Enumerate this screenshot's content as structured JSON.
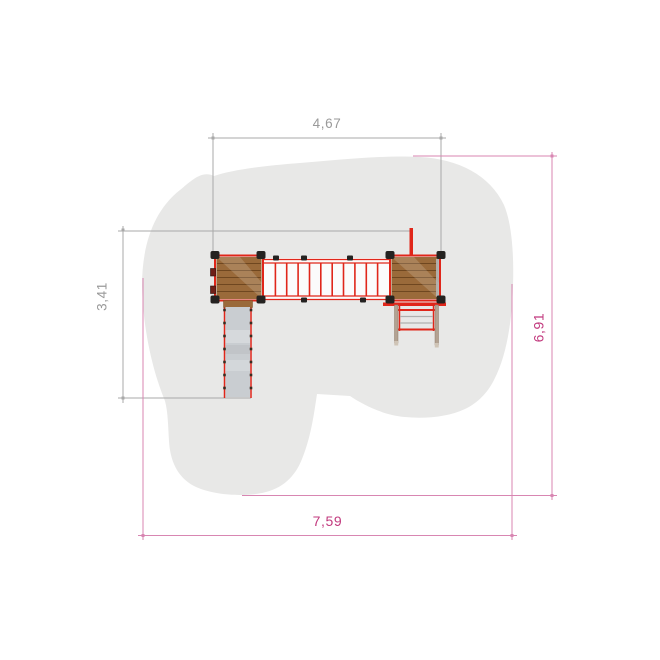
{
  "drawing": {
    "view": "top-view plan of playground unit with safety zone",
    "components": [
      "safety-zone",
      "left-platform",
      "rope-bridge",
      "right-platform",
      "slide",
      "ladder",
      "fireman-pole"
    ]
  },
  "dimensions": {
    "top": "4,67",
    "left": "3,41",
    "right": "6,91",
    "bottom": "7,59"
  },
  "colors": {
    "background": "#ffffff",
    "safety_zone": "#e8e8e7",
    "wood": "#9a6a3a",
    "wood_plank_line": "#6f4720",
    "frame_red": "#e0261a",
    "slide": "#c9cdd1",
    "hardware_black": "#242220",
    "ladder_rail": "#b3a292",
    "dimension_primary_text": "#c23a7e",
    "dimension_primary_line": "#d886b2",
    "dimension_secondary_text": "#9a9a9a",
    "dimension_secondary_line": "#a9a9a9"
  }
}
